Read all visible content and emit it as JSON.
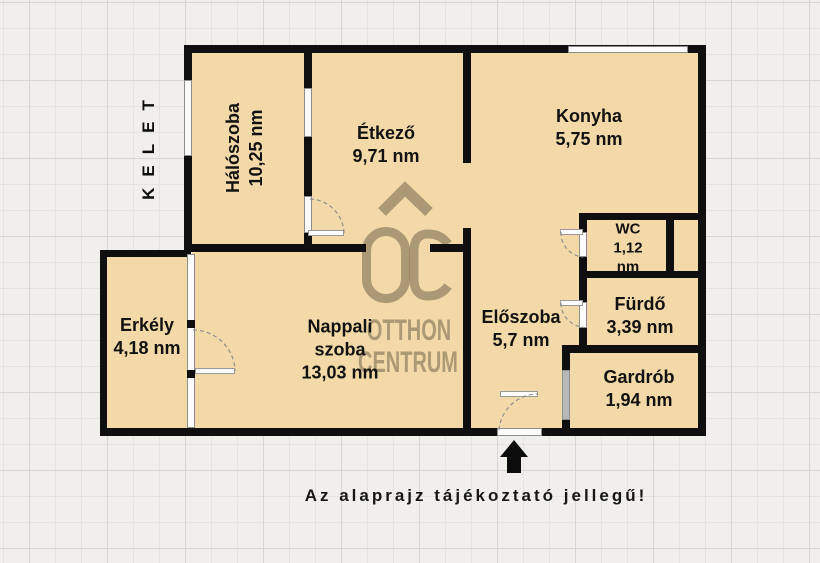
{
  "compass": {
    "direction": "KELET"
  },
  "rooms": {
    "haloszoba": {
      "name": "Hálószoba",
      "area": "10,25 nm"
    },
    "etkezo": {
      "name": "Étkező",
      "area": "9,71 nm"
    },
    "konyha": {
      "name": "Konyha",
      "area": "5,75 nm"
    },
    "wc": {
      "name": "WC",
      "area": "1,12",
      "unit": "nm"
    },
    "furdo": {
      "name": "Fürdő",
      "area": "3,39 nm"
    },
    "gardrob": {
      "name": "Gardrób",
      "area": "1,94 nm"
    },
    "eloszoba": {
      "name": "Előszoba",
      "area": "5,7 nm"
    },
    "nappali": {
      "name_line1": "Nappali",
      "name_line2": "szoba",
      "area": "13,03 nm"
    },
    "erkely": {
      "name": "Erkély",
      "area": "4,18 nm"
    }
  },
  "watermark": {
    "logo_text": "OC",
    "line1": "OTTHON",
    "line2": "CENTRUM"
  },
  "footer": {
    "note": "Az alaprajz tájékoztató jellegű!"
  },
  "colors": {
    "floor": "#f3d9a7",
    "wall": "#0f0f0f",
    "watermark": "#70634d",
    "grid_background": "#f0efeb",
    "opening": "#fbfbfa"
  }
}
